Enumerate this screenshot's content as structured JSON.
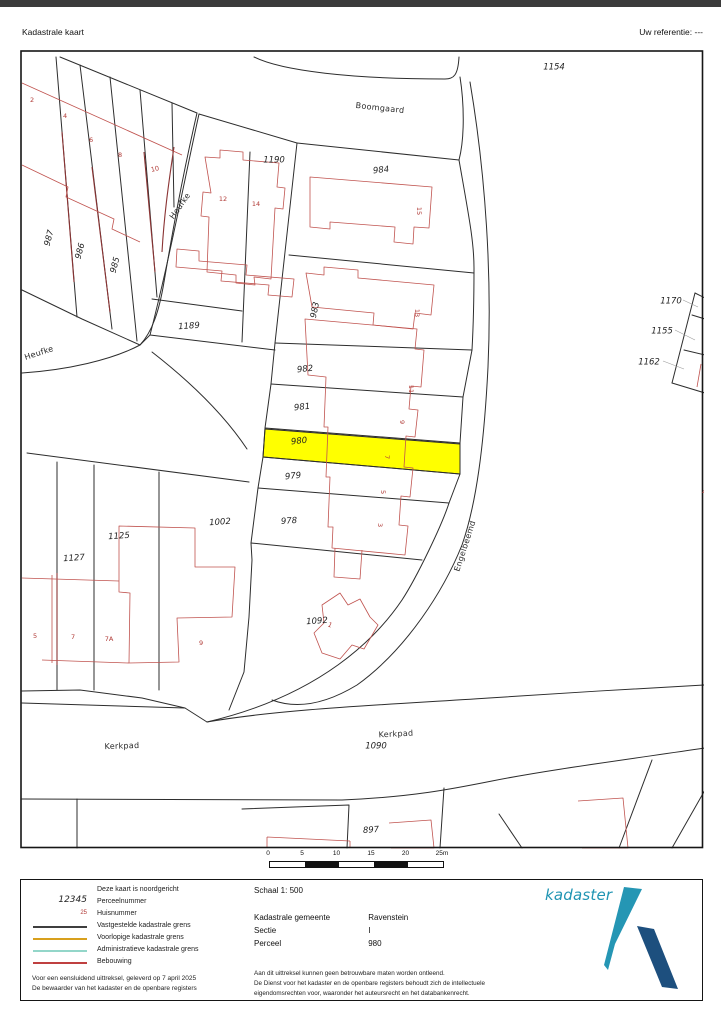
{
  "header": {
    "title": "Kadastrale kaart",
    "reference": "Uw referentie: ---"
  },
  "map": {
    "colors": {
      "highlight": "#ffff00",
      "boundary": "#2d2d2d",
      "building": "#c0534f"
    },
    "highlighted_parcel": "980",
    "labels": [
      {
        "type": "parcel",
        "text": "1154",
        "x": 532,
        "y": 10,
        "rot": 0
      },
      {
        "type": "parcel",
        "text": "1190",
        "x": 252,
        "y": 103,
        "rot": 0
      },
      {
        "type": "parcel",
        "text": "1189",
        "x": 167,
        "y": 269,
        "rot": -4
      },
      {
        "type": "parcel",
        "text": "984",
        "x": 359,
        "y": 113,
        "rot": -6
      },
      {
        "type": "parcel",
        "text": "983",
        "x": 293,
        "y": 253,
        "rot": -78
      },
      {
        "type": "parcel",
        "text": "982",
        "x": 283,
        "y": 312,
        "rot": -6
      },
      {
        "type": "parcel",
        "text": "981",
        "x": 280,
        "y": 350,
        "rot": -6
      },
      {
        "type": "parcel",
        "text": "980",
        "x": 277,
        "y": 384,
        "rot": -6
      },
      {
        "type": "parcel",
        "text": "979",
        "x": 271,
        "y": 419,
        "rot": -6
      },
      {
        "type": "parcel",
        "text": "978",
        "x": 267,
        "y": 464,
        "rot": -4
      },
      {
        "type": "parcel",
        "text": "1092",
        "x": 295,
        "y": 564,
        "rot": -4
      },
      {
        "type": "parcel",
        "text": "1002",
        "x": 198,
        "y": 465,
        "rot": -4
      },
      {
        "type": "parcel",
        "text": "1125",
        "x": 97,
        "y": 479,
        "rot": -4
      },
      {
        "type": "parcel",
        "text": "1127",
        "x": 52,
        "y": 501,
        "rot": -4
      },
      {
        "type": "parcel",
        "text": "987",
        "x": 27,
        "y": 181,
        "rot": -75
      },
      {
        "type": "parcel",
        "text": "986",
        "x": 58,
        "y": 194,
        "rot": -75
      },
      {
        "type": "parcel",
        "text": "985",
        "x": 93,
        "y": 208,
        "rot": -75
      },
      {
        "type": "parcel",
        "text": "1090",
        "x": 354,
        "y": 689,
        "rot": 0
      },
      {
        "type": "parcel",
        "text": "897",
        "x": 349,
        "y": 773,
        "rot": -4
      },
      {
        "type": "parcel",
        "text": "1170",
        "x": 649,
        "y": 244,
        "rot": 0
      },
      {
        "type": "parcel",
        "text": "1155",
        "x": 640,
        "y": 274,
        "rot": 0
      },
      {
        "type": "parcel",
        "text": "1162",
        "x": 627,
        "y": 305,
        "rot": 0
      },
      {
        "type": "street",
        "text": "Boomgaard",
        "x": 358,
        "y": 51,
        "rot": 6
      },
      {
        "type": "street",
        "text": "Heufke",
        "x": 158,
        "y": 149,
        "rot": -55
      },
      {
        "type": "street",
        "text": "Heufke",
        "x": 17,
        "y": 296,
        "rot": -18
      },
      {
        "type": "street",
        "text": "Engelbeemd",
        "x": 443,
        "y": 489,
        "rot": -72
      },
      {
        "type": "street",
        "text": "Kerkpad",
        "x": 100,
        "y": 689,
        "rot": -2
      },
      {
        "type": "street",
        "text": "Kerkpad",
        "x": 374,
        "y": 677,
        "rot": -3
      },
      {
        "type": "house",
        "text": "2",
        "x": 10,
        "y": 43,
        "rot": 0
      },
      {
        "type": "house",
        "text": "4",
        "x": 43,
        "y": 59,
        "rot": 0
      },
      {
        "type": "house",
        "text": "6",
        "x": 69,
        "y": 83,
        "rot": 0
      },
      {
        "type": "house",
        "text": "8",
        "x": 98,
        "y": 98,
        "rot": 0
      },
      {
        "type": "house",
        "text": "10",
        "x": 133,
        "y": 112,
        "rot": -12
      },
      {
        "type": "house",
        "text": "12",
        "x": 201,
        "y": 142,
        "rot": 0
      },
      {
        "type": "house",
        "text": "14",
        "x": 234,
        "y": 147,
        "rot": 0
      },
      {
        "type": "house",
        "text": "15",
        "x": 397,
        "y": 154,
        "rot": 90
      },
      {
        "type": "house",
        "text": "13",
        "x": 395,
        "y": 256,
        "rot": 90
      },
      {
        "type": "house",
        "text": "11",
        "x": 389,
        "y": 332,
        "rot": 90
      },
      {
        "type": "house",
        "text": "9",
        "x": 380,
        "y": 365,
        "rot": 90
      },
      {
        "type": "house",
        "text": "7",
        "x": 365,
        "y": 400,
        "rot": 90
      },
      {
        "type": "house",
        "text": "5",
        "x": 361,
        "y": 435,
        "rot": 90
      },
      {
        "type": "house",
        "text": "3",
        "x": 358,
        "y": 468,
        "rot": 90
      },
      {
        "type": "house",
        "text": "1",
        "x": 308,
        "y": 568,
        "rot": 25
      },
      {
        "type": "house",
        "text": "5",
        "x": 13,
        "y": 579,
        "rot": 0
      },
      {
        "type": "house",
        "text": "7",
        "x": 51,
        "y": 580,
        "rot": 0
      },
      {
        "type": "house",
        "text": "7A",
        "x": 87,
        "y": 582,
        "rot": 0
      },
      {
        "type": "house",
        "text": "9",
        "x": 179,
        "y": 586,
        "rot": 0
      },
      {
        "type": "house",
        "text": "4",
        "x": 682,
        "y": 435,
        "rot": 0
      }
    ]
  },
  "scalebar": {
    "ticks": [
      "0",
      "5",
      "10",
      "15",
      "20",
      "25m"
    ]
  },
  "legend": {
    "north_note": "Deze kaart is noordgericht",
    "items": [
      {
        "sample": "12345",
        "label": "Perceelnummer"
      },
      {
        "sample": "25",
        "label": "Huisnummer"
      },
      {
        "sample_color": "#3f3f3f",
        "label": "Vastgestelde kadastrale grens"
      },
      {
        "sample_color": "#d8a01d",
        "label": "Voorlopige kadastrale grens"
      },
      {
        "sample_color": "#93d6c9",
        "label": "Administratieve kadastrale grens"
      },
      {
        "sample_color": "#bf4040",
        "label": "Bebouwing"
      }
    ],
    "footer_line1": "Voor een eensluidend uittreksel, geleverd op 7 april 2025",
    "footer_line2": "De bewaarder van het kadaster en de openbare registers"
  },
  "details": {
    "scale_label": "Schaal 1: 500",
    "rows": [
      {
        "label": "Kadastrale gemeente",
        "value": "Ravenstein"
      },
      {
        "label": "Sectie",
        "value": "I"
      },
      {
        "label": "Perceel",
        "value": "980"
      }
    ],
    "disclaimer1": "Aan dit uittreksel kunnen geen betrouwbare maten worden ontleend.",
    "disclaimer2": "De Dienst voor het kadaster en de openbare registers behoudt zich de intellectuele",
    "disclaimer3": "eigendomsrechten voor, waaronder het auteursrecht en het databankenrecht.",
    "logo_text": "kadaster",
    "logo_colors": {
      "teal": "#2596b4",
      "navy": "#1d4f7e"
    }
  }
}
